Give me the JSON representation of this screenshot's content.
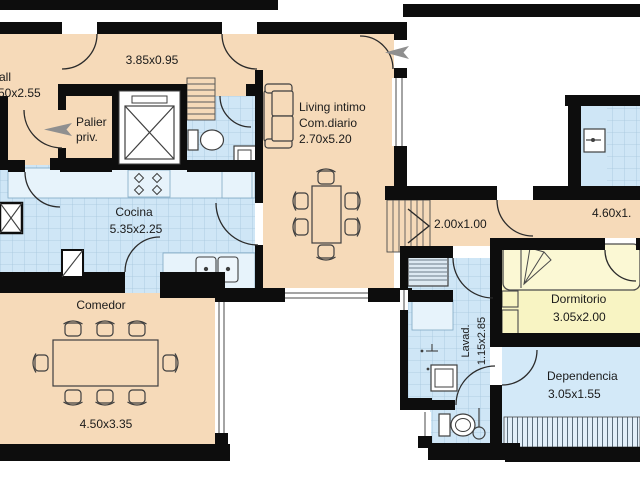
{
  "plan": {
    "title": "apartment-floor-plan",
    "colors": {
      "wall": "#0d0d0d",
      "room_tan": "#f6dab9",
      "tile_blue": "#cfe6f6",
      "tile_grid": "#a6c6dd",
      "counter_blue": "#e7f3fb",
      "bedroom_yellow": "#f8f4c3",
      "dependencia_blue": "#d3e9f8",
      "entry_arrow_gray": "#8f8f8f",
      "text": "#1b1b1b"
    },
    "rooms": {
      "hall": {
        "label_line1": "all",
        "label_line2": "50x2.55"
      },
      "corridor_top": {
        "dims": "3.85x0.95"
      },
      "palier": {
        "name_line1": "Palier",
        "name_line2": "priv."
      },
      "living": {
        "name_line1": "Living intimo",
        "name_line2": "Com.diario",
        "dims": "2.70x5.20"
      },
      "cocina": {
        "name": "Cocina",
        "dims": "5.35x2.25"
      },
      "comedor": {
        "name": "Comedor",
        "dims": "4.50x3.35"
      },
      "passage": {
        "dims": "2.00x1.00"
      },
      "corridor_right": {
        "dims": "4.60x1."
      },
      "lavadero": {
        "name": "Lavad.",
        "dims": "1.15x2.85"
      },
      "dormitorio": {
        "name": "Dormitorio",
        "dims": "3.05x2.00"
      },
      "dependencia": {
        "name": "Dependencia",
        "dims": "3.05x1.55"
      }
    }
  }
}
